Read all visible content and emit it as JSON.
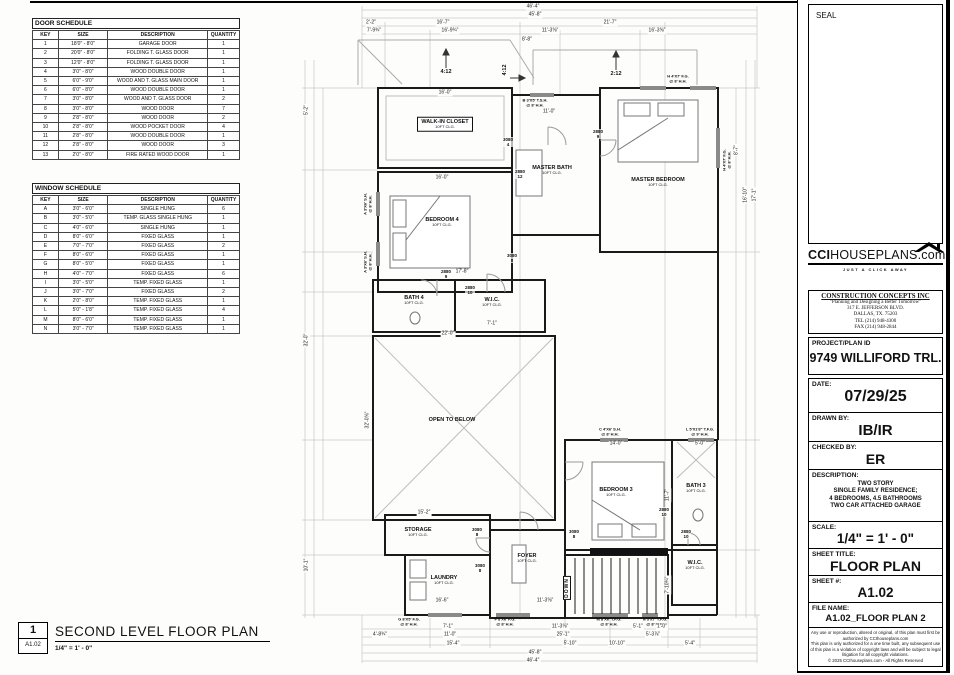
{
  "door_schedule": {
    "title": "DOOR SCHEDULE",
    "headers": [
      "KEY",
      "SIZE",
      "DESCRIPTION",
      "QUANTITY"
    ],
    "rows": [
      [
        "1",
        "18'0\" - 8'0\"",
        "GARAGE DOOR",
        "1"
      ],
      [
        "2",
        "20'0\" - 8'0\"",
        "FOLDING T. GLASS DOOR",
        "1"
      ],
      [
        "3",
        "12'0\" - 8'0\"",
        "FOLDING T. GLASS DOOR",
        "1"
      ],
      [
        "4",
        "3'0\" - 8'0\"",
        "WOOD DOUBLE DOOR",
        "1"
      ],
      [
        "5",
        "6'0\" - 9'0\"",
        "WOOD AND T. GLASS MAIN DOOR",
        "1"
      ],
      [
        "6",
        "6'0\" - 8'0\"",
        "WOOD DOUBLE DOOR",
        "1"
      ],
      [
        "7",
        "3'0\" - 8'0\"",
        "WOOD AND T. GLASS DOOR",
        "2"
      ],
      [
        "8",
        "3'0\" - 8'0\"",
        "WOOD DOOR",
        "7"
      ],
      [
        "9",
        "2'8\" - 8'0\"",
        "WOOD DOOR",
        "2"
      ],
      [
        "10",
        "2'8\" - 8'0\"",
        "WOOD POCKET DOOR",
        "4"
      ],
      [
        "11",
        "2'8\" - 8'0\"",
        "WOOD DOUBLE DOOR",
        "1"
      ],
      [
        "12",
        "2'8\" - 8'0\"",
        "WOOD DOOR",
        "3"
      ],
      [
        "13",
        "2'0\" - 8'0\"",
        "FIRE RATED WOOD DOOR",
        "1"
      ]
    ]
  },
  "window_schedule": {
    "title": "WINDOW SCHEDULE",
    "headers": [
      "KEY",
      "SIZE",
      "DESCRIPTION",
      "QUANTITY"
    ],
    "rows": [
      [
        "A",
        "3'0\" - 6'0\"",
        "SINGLE HUNG",
        "6"
      ],
      [
        "B",
        "3'0\" - 5'0\"",
        "TEMP. GLASS SINGLE HUNG",
        "1"
      ],
      [
        "C",
        "4'0\" - 6'0\"",
        "SINGLE HUNG",
        "1"
      ],
      [
        "D",
        "8'0\" - 6'0\"",
        "FIXED GLASS",
        "1"
      ],
      [
        "E",
        "7'0\" - 7'0\"",
        "FIXED GLASS",
        "2"
      ],
      [
        "F",
        "8'0\" - 6'0\"",
        "FIXED GLASS",
        "1"
      ],
      [
        "G",
        "8'0\" - 5'0\"",
        "FIXED GLASS",
        "1"
      ],
      [
        "H",
        "4'0\" - 7'0\"",
        "FIXED GLASS",
        "6"
      ],
      [
        "I",
        "3'0\" - 5'0\"",
        "TEMP. FIXED GLASS",
        "1"
      ],
      [
        "J",
        "3'0\" - 7'0\"",
        "FIXED GLASS",
        "2"
      ],
      [
        "K",
        "2'0\" - 8'0\"",
        "TEMP. FIXED GLASS",
        "1"
      ],
      [
        "L",
        "5'0\" - 1'8\"",
        "TEMP. FIXED GLASS",
        "4"
      ],
      [
        "M",
        "8'0\" - 6'0\"",
        "TEMP. FIXED GLASS",
        "1"
      ],
      [
        "N",
        "3'0\" - 7'0\"",
        "TEMP. FIXED GLASS",
        "1"
      ]
    ]
  },
  "drawing_title": {
    "number": "1",
    "sheet_ref": "A1.02",
    "title": "SECOND LEVEL FLOOR PLAN",
    "scale": "1/4\" = 1' - 0\""
  },
  "title_block": {
    "seal_label": "SEAL",
    "logo": {
      "cci": "CCI",
      "rest": "HOUSEPLANS",
      "dotcom": ".com",
      "tagline": "JUST A CLICK AWAY"
    },
    "company": {
      "name": "CONSTRUCTION CONCEPTS INC",
      "tagline": "\"Planning and Designing a Better Tomorrow\"",
      "address1": "317 E. JEFFERSON BLVD.",
      "address2": "DALLAS, TX. 75203",
      "tel": "TEL (214) 948-4300",
      "fax": "FAX (214) 948-2844"
    },
    "project": {
      "label": "PROJECT/PLAN ID",
      "value": "9749 WILLIFORD TRL."
    },
    "date": {
      "label": "DATE:",
      "value": "07/29/25"
    },
    "drawn": {
      "label": "DRAWN BY:",
      "value": "IB/IR"
    },
    "checked": {
      "label": "CHECKED BY:",
      "value": "ER"
    },
    "description": {
      "label": "DESCRIPTION:",
      "lines": [
        "TWO STORY",
        "SINGLE FAMILY RESIDENCE;",
        "4 BEDROOMS, 4.5 BATHROOMS",
        "TWO CAR ATTACHED GARAGE"
      ]
    },
    "scale": {
      "label": "SCALE:",
      "value": "1/4\" = 1' - 0\""
    },
    "sheet_title": {
      "label": "SHEET TITLE:",
      "value": "FLOOR PLAN"
    },
    "sheet_num": {
      "label": "SHEET #:",
      "value": "A1.02"
    },
    "file_name": {
      "label": "FILE NAME:",
      "value": "A1.02_FLOOR PLAN 2"
    },
    "copyright": [
      "Any use or reproduction, altered or original, of this plan must first be",
      "authorized by CCIhouseplans.com",
      "This plan is only authorized for a one time built, any subsequent use",
      "of this plan is a violation of copyright laws and will be subject to legal",
      "litigation for all copyright violations.",
      "© 2025 CCIhouseplans.com - All Rights Reserved"
    ]
  },
  "plan": {
    "rooms": [
      {
        "name": "WALK-IN CLOSET",
        "sub": "10FT CLG.",
        "x": 445,
        "y": 124,
        "boxed": true
      },
      {
        "name": "MASTER BATH",
        "sub": "10FT CLG.",
        "x": 552,
        "y": 170,
        "boxed": false
      },
      {
        "name": "MASTER BEDROOM",
        "sub": "10FT CLG.",
        "x": 658,
        "y": 182,
        "boxed": false
      },
      {
        "name": "BEDROOM 4",
        "sub": "10FT CLG.",
        "x": 442,
        "y": 222,
        "boxed": false
      },
      {
        "name": "BATH 4",
        "sub": "10FT CLG.",
        "x": 414,
        "y": 300,
        "boxed": false
      },
      {
        "name": "W.I.C.",
        "sub": "10FT CLG.",
        "x": 492,
        "y": 302,
        "boxed": false
      },
      {
        "name": "OPEN TO BELOW",
        "sub": "",
        "x": 452,
        "y": 420,
        "boxed": false
      },
      {
        "name": "STORAGE",
        "sub": "10FT CLG.",
        "x": 418,
        "y": 532,
        "boxed": false
      },
      {
        "name": "LAUNDRY",
        "sub": "10FT CLG.",
        "x": 444,
        "y": 580,
        "boxed": false
      },
      {
        "name": "FOYER",
        "sub": "10FT CLG.",
        "x": 527,
        "y": 558,
        "boxed": false
      },
      {
        "name": "BEDROOM 3",
        "sub": "10FT CLG.",
        "x": 616,
        "y": 492,
        "boxed": false
      },
      {
        "name": "BATH 3",
        "sub": "10FT CLG.",
        "x": 696,
        "y": 488,
        "boxed": false
      },
      {
        "name": "W.I.C.",
        "sub": "10FT CLG.",
        "x": 695,
        "y": 565,
        "boxed": false
      }
    ],
    "door_tags": [
      {
        "t": "3080",
        "n": "4",
        "x": 508,
        "y": 142
      },
      {
        "t": "2880",
        "n": "12",
        "x": 520,
        "y": 174
      },
      {
        "t": "2880",
        "n": "9",
        "x": 598,
        "y": 134
      },
      {
        "t": "3080",
        "n": "8",
        "x": 512,
        "y": 258
      },
      {
        "t": "2880",
        "n": "9",
        "x": 446,
        "y": 274
      },
      {
        "t": "2880",
        "n": "10",
        "x": 470,
        "y": 290
      },
      {
        "t": "3080",
        "n": "8",
        "x": 477,
        "y": 532
      },
      {
        "t": "3080",
        "n": "8",
        "x": 480,
        "y": 568
      },
      {
        "t": "3080",
        "n": "8",
        "x": 574,
        "y": 534
      },
      {
        "t": "2880",
        "n": "10",
        "x": 664,
        "y": 512
      },
      {
        "t": "2880",
        "n": "10",
        "x": 686,
        "y": 534
      }
    ],
    "window_tags": [
      {
        "t": "B 3'X5' T.S.H.",
        "s": "@ 8' H.H.",
        "x": 535,
        "y": 103,
        "rot": false
      },
      {
        "t": "H 4'X7' F.G.",
        "s": "@ 8' H.H.",
        "x": 678,
        "y": 79,
        "rot": false
      },
      {
        "t": "A 3'X6' S.H.",
        "s": "@ 8' H.H.",
        "x": 368,
        "y": 204,
        "rot": true
      },
      {
        "t": "A 3'X6' S.H.",
        "s": "@ 8' H.H.",
        "x": 368,
        "y": 262,
        "rot": true
      },
      {
        "t": "H 4'X7' F.G.",
        "s": "@ 8' H.H.",
        "x": 727,
        "y": 160,
        "rot": true
      },
      {
        "t": "C 4'X6' S.H.",
        "s": "@ 8' H.H.",
        "x": 610,
        "y": 432,
        "rot": false
      },
      {
        "t": "L 5'X1'8\" T.F.G.",
        "s": "@ 9' H.H.",
        "x": 700,
        "y": 432,
        "rot": false
      },
      {
        "t": "G 8'X5' F.G.",
        "s": "@ 8' H.H.",
        "x": 409,
        "y": 622,
        "rot": false
      },
      {
        "t": "F 8'X6' F.G.",
        "s": "@ 8' H.H.",
        "x": 505,
        "y": 622,
        "rot": false
      },
      {
        "t": "M 8'X6' T.F.G.",
        "s": "@ 8' H.H.",
        "x": 609,
        "y": 622,
        "rot": false
      },
      {
        "t": "N 3'X7' T.F.G.",
        "s": "@ 8' H.H.",
        "x": 655,
        "y": 622,
        "rot": false
      }
    ],
    "dims": [
      {
        "t": "46'-4\"",
        "x": 533,
        "y": 7,
        "rot": false
      },
      {
        "t": "45'-8\"",
        "x": 535,
        "y": 15,
        "rot": false
      },
      {
        "t": "2'-2\"",
        "x": 371,
        "y": 23,
        "rot": false
      },
      {
        "t": "16'-7\"",
        "x": 443,
        "y": 23,
        "rot": false
      },
      {
        "t": "21'-7\"",
        "x": 610,
        "y": 23,
        "rot": false
      },
      {
        "t": "7'-9¾\"",
        "x": 374,
        "y": 31,
        "rot": false
      },
      {
        "t": "16'-9¾\"",
        "x": 450,
        "y": 31,
        "rot": false
      },
      {
        "t": "11'-3⅝\"",
        "x": 550,
        "y": 31,
        "rot": false
      },
      {
        "t": "16'-3⅝\"",
        "x": 657,
        "y": 31,
        "rot": false
      },
      {
        "t": "8'-8\"",
        "x": 527,
        "y": 40,
        "rot": false
      },
      {
        "t": "16'-0\"",
        "x": 445,
        "y": 93,
        "rot": false
      },
      {
        "t": "11'-0\"",
        "x": 549,
        "y": 112,
        "rot": false
      },
      {
        "t": "16'-0\"",
        "x": 442,
        "y": 178,
        "rot": false
      },
      {
        "t": "17'-8\"",
        "x": 462,
        "y": 272,
        "rot": false
      },
      {
        "t": "22'-0\"",
        "x": 448,
        "y": 334,
        "rot": false
      },
      {
        "t": "7'-1\"",
        "x": 492,
        "y": 324,
        "rot": false
      },
      {
        "t": "15'-2\"",
        "x": 424,
        "y": 513,
        "rot": false
      },
      {
        "t": "16'-6\"",
        "x": 442,
        "y": 601,
        "rot": false
      },
      {
        "t": "11'-3⅝\"",
        "x": 545,
        "y": 601,
        "rot": false
      },
      {
        "t": "14'-0\"",
        "x": 616,
        "y": 444,
        "rot": false
      },
      {
        "t": "5'-0\"",
        "x": 700,
        "y": 444,
        "rot": false
      },
      {
        "t": "11'-7\"",
        "x": 668,
        "y": 495,
        "rot": true
      },
      {
        "t": "7'-10¼\"",
        "x": 668,
        "y": 585,
        "rot": true
      },
      {
        "t": "32'-0⅝\"",
        "x": 368,
        "y": 420,
        "rot": true
      },
      {
        "t": "5'-2\"",
        "x": 307,
        "y": 110,
        "rot": true
      },
      {
        "t": "32'-0\"",
        "x": 307,
        "y": 340,
        "rot": true
      },
      {
        "t": "10'-1\"",
        "x": 307,
        "y": 565,
        "rot": true
      },
      {
        "t": "8'-7\"",
        "x": 737,
        "y": 150,
        "rot": true
      },
      {
        "t": "16'-10\"",
        "x": 746,
        "y": 195,
        "rot": true
      },
      {
        "t": "17'-1\"",
        "x": 755,
        "y": 195,
        "rot": true
      },
      {
        "t": "7'-1\"",
        "x": 448,
        "y": 627,
        "rot": false
      },
      {
        "t": "11'-3⅝\"",
        "x": 560,
        "y": 627,
        "rot": false
      },
      {
        "t": "5'-1\"",
        "x": 638,
        "y": 627,
        "rot": false
      },
      {
        "t": "1'-0\"",
        "x": 662,
        "y": 627,
        "rot": false
      },
      {
        "t": "4'-8¾\"",
        "x": 380,
        "y": 635,
        "rot": false
      },
      {
        "t": "11'-0\"",
        "x": 450,
        "y": 635,
        "rot": false
      },
      {
        "t": "25'-1\"",
        "x": 563,
        "y": 635,
        "rot": false
      },
      {
        "t": "5'-3⅞\"",
        "x": 653,
        "y": 635,
        "rot": false
      },
      {
        "t": "15'-4\"",
        "x": 453,
        "y": 644,
        "rot": false
      },
      {
        "t": "5'-10\"",
        "x": 570,
        "y": 644,
        "rot": false
      },
      {
        "t": "10'-10\"",
        "x": 617,
        "y": 644,
        "rot": false
      },
      {
        "t": "5'-4\"",
        "x": 690,
        "y": 644,
        "rot": false
      },
      {
        "t": "45'-8\"",
        "x": 535,
        "y": 653,
        "rot": false
      },
      {
        "t": "46'-4\"",
        "x": 533,
        "y": 661,
        "rot": false
      }
    ],
    "pitches": [
      {
        "t": "4:12",
        "x": 446,
        "y": 72,
        "rot": false
      },
      {
        "t": "2:12",
        "x": 616,
        "y": 74,
        "rot": false
      },
      {
        "t": "4:12",
        "x": 505,
        "y": 70,
        "rot": true
      }
    ],
    "stair_label": {
      "t": "DOWN",
      "x": 567,
      "y": 588
    }
  }
}
